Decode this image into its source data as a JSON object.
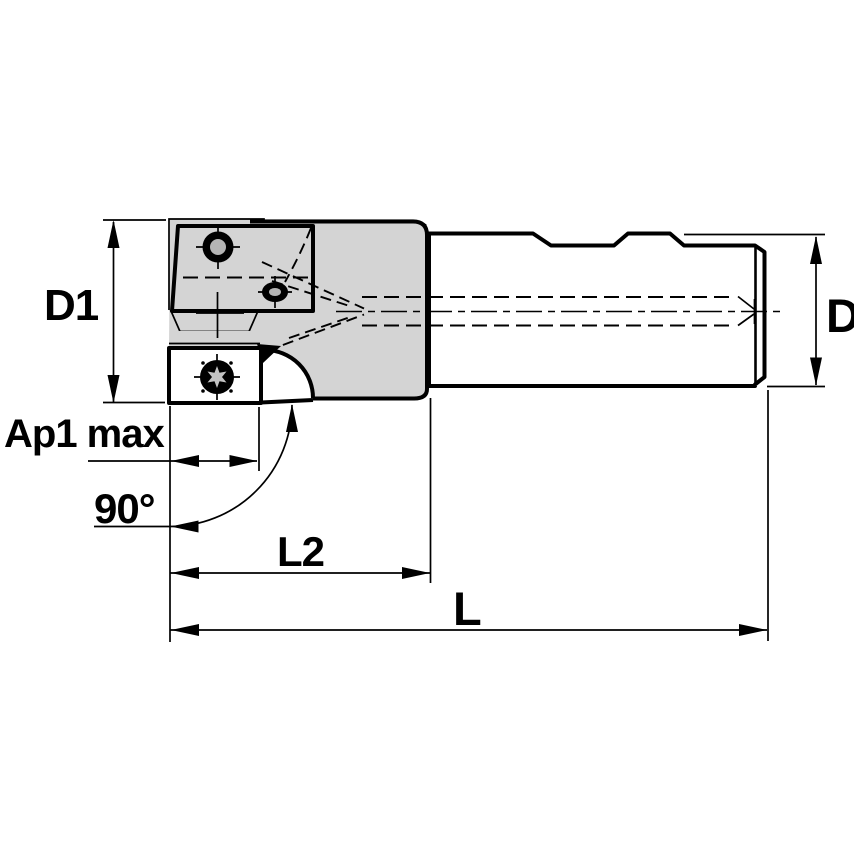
{
  "drawing": {
    "description": "Dimensioned side-view engineering drawing of an indexable 90-degree square shoulder end mill with cylindrical shank",
    "labels": {
      "d1": "D1",
      "ap1_max": "Ap1 max",
      "angle_90": "90°",
      "l2": "L2",
      "l": "L",
      "d": "D"
    },
    "colors": {
      "body_fill": "#d4d4d4",
      "insert_fill": "#ffffff",
      "hole_fill": "#b4b4b4",
      "screw_star_fill": "#c3c3c3",
      "line": "#000000",
      "background": "#ffffff"
    }
  }
}
